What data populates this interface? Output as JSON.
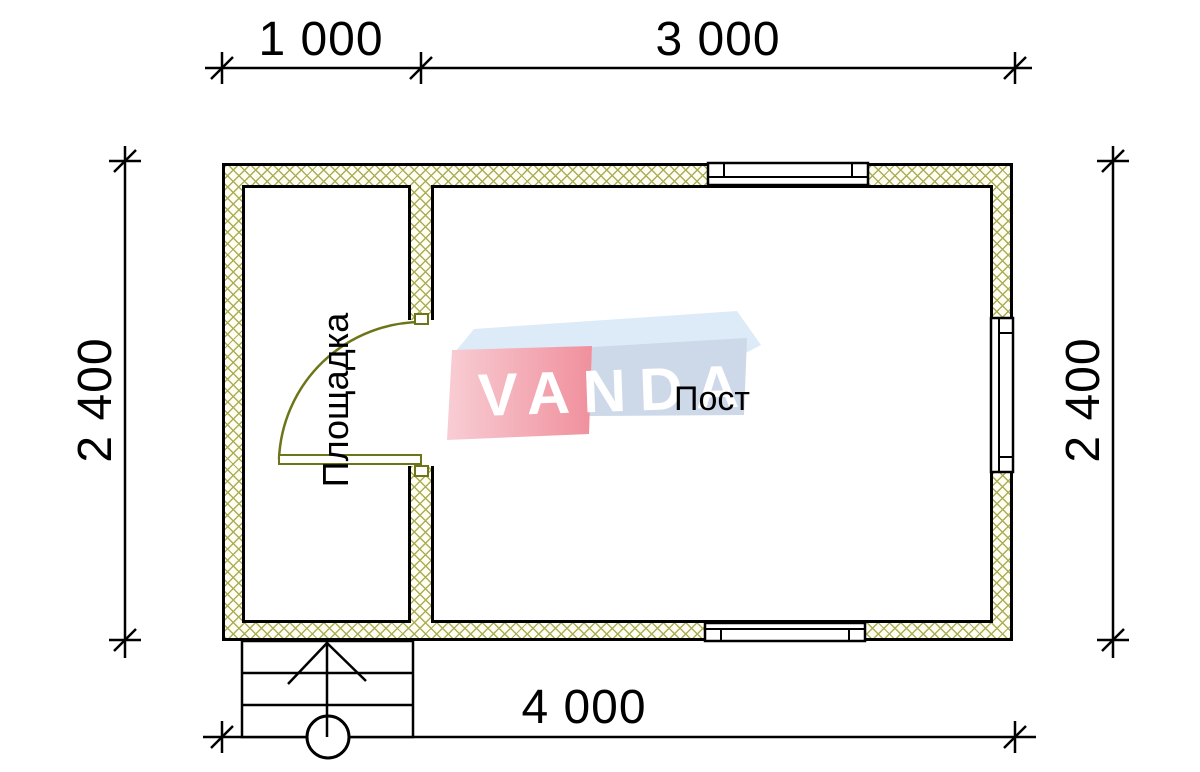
{
  "title": "floor-plan",
  "dimensions": {
    "top_segment_1": "1 000",
    "top_segment_2": "3 000",
    "bottom_total": "4 000",
    "left_height": "2 400",
    "right_height": "2 400"
  },
  "rooms": {
    "left_label": "Площадка",
    "right_label": "Пост"
  },
  "watermark": {
    "brand": "VANDA"
  },
  "colors": {
    "wall_hatch": "#acad58",
    "door": "#6e7418",
    "logo_red": "#f0909d",
    "logo_red_light": "#f8cdd4",
    "logo_blue": "#cdd9e9",
    "logo_blue_light": "#dcebf7",
    "line": "#000000"
  }
}
